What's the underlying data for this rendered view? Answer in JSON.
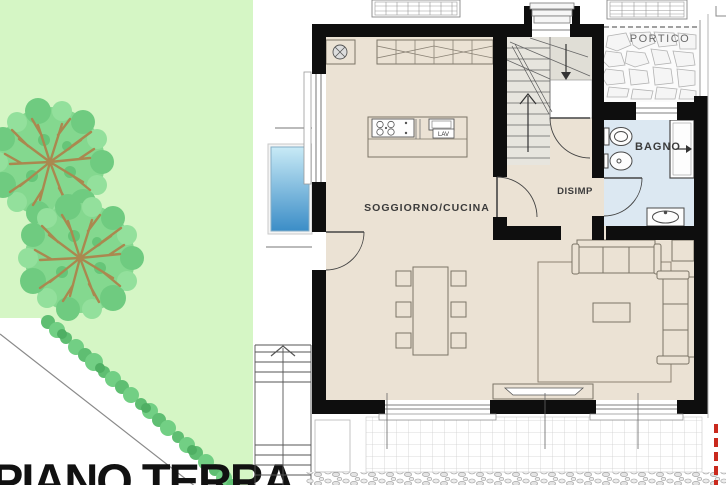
{
  "plan": {
    "title": "PIANO TERRA",
    "rooms": {
      "living_kitchen": "SOGGIORNO/CUCINA",
      "hallway": "DISIMP",
      "bathroom": "BAGNO",
      "porch": "PORTICO"
    },
    "labels": {
      "kitchen_sink": "LAV"
    },
    "colors": {
      "lawn": "#d5f6c5",
      "hedge": "#5fbe72",
      "tree_foliage": "#84d88f",
      "tree_branch": "#aa884f",
      "interior_floor": "#ebe2d4",
      "bathroom_floor": "#dce8f2",
      "stair_floor": "#e7e5de",
      "porch_floor": "#fbfbfb",
      "wall": "#0e0e0e",
      "pool_shallow": "#c8eaf6",
      "pool_deep": "#3b8dc7",
      "boundary_marker": "#c9291d"
    }
  }
}
